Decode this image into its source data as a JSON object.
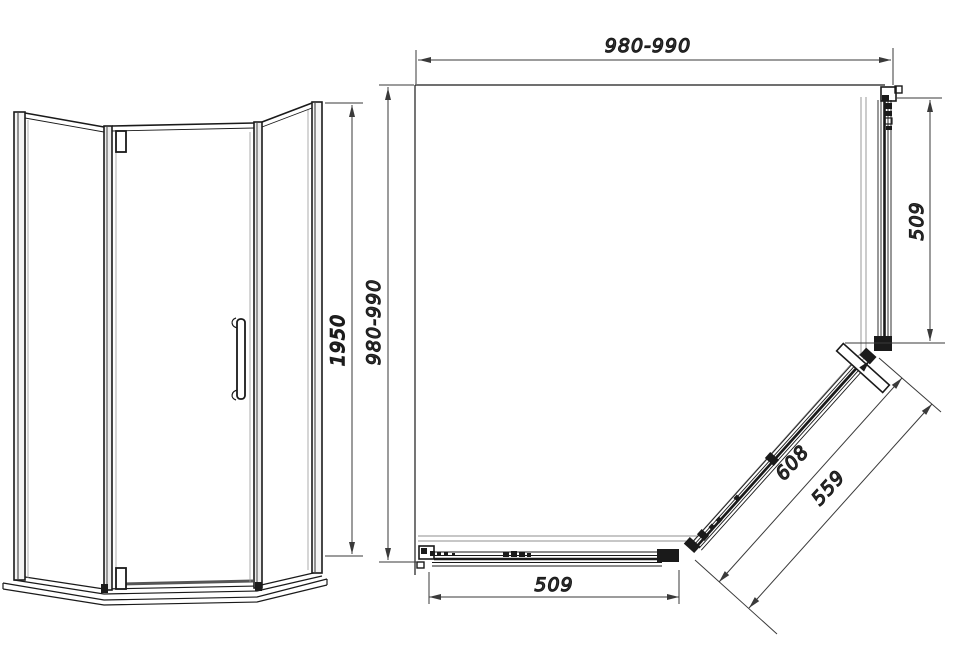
{
  "drawing": {
    "title": "pentagonal-shower-enclosure-technical-drawing",
    "elevation": {
      "height_label": "1950"
    },
    "plan": {
      "width_label": "980-990",
      "depth_label": "980-990",
      "side_panel_label": "509",
      "bottom_panel_label": "509",
      "door_outer_label": "608",
      "door_opening_label": "559"
    },
    "colors": {
      "line": "#1a1a1a",
      "dim": "#3a3a3a",
      "glass_edge": "#8f8f8f"
    }
  }
}
